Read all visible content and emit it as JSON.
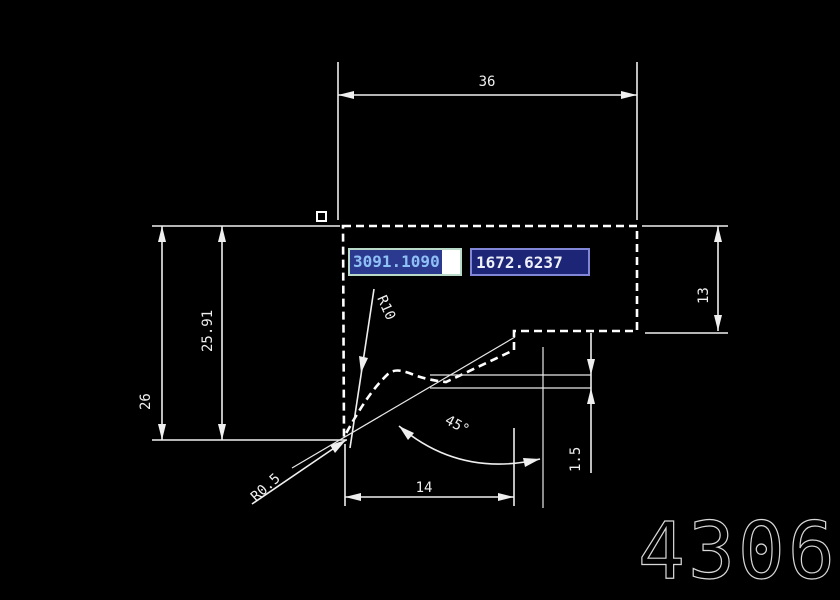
{
  "app": {
    "background": "#000000",
    "line_color": "#efefef"
  },
  "coordinate_inputs": {
    "x_value": "3091.1090",
    "y_value": "1672.6237",
    "x_selection_bg": "#2b3a8e",
    "x_text_color": "#8fc0f5",
    "y_box_bg": "#1d2577",
    "y_border_color": "#8187d6"
  },
  "dimensions": {
    "top_width": "36",
    "overall_height": "26",
    "inner_height": "25.91",
    "right_step_height": "13",
    "small_offset": "1.5",
    "bottom_width": "14",
    "fillet_radius": "R10",
    "corner_radius": "R0.5",
    "chamfer_angle": "45°"
  },
  "part_number": "4306"
}
